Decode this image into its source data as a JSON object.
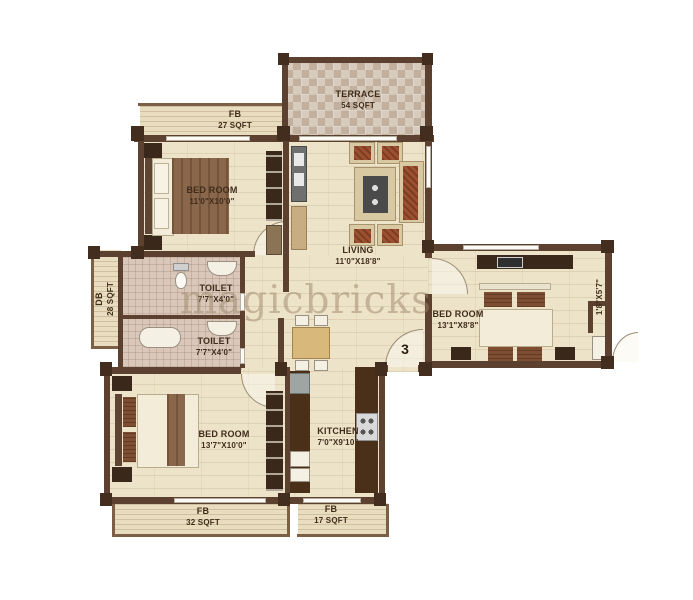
{
  "watermark": "magicbricks",
  "unit_number": "3",
  "rooms": {
    "fb_top": {
      "name": "FB",
      "area": "27 SQFT"
    },
    "terrace": {
      "name": "TERRACE",
      "area": "54 SQFT"
    },
    "bedroom_top": {
      "name": "BED ROOM",
      "dim": "11'0\"X10'0\""
    },
    "living": {
      "name": "LIVING",
      "dim": "11'0\"X18'8\""
    },
    "toilet_upper": {
      "name": "TOILET",
      "dim": "7'7\"X4'0\""
    },
    "toilet_lower": {
      "name": "TOILET",
      "dim": "7'7\"X4'0\""
    },
    "db": {
      "name": "DB",
      "area": "28 SQFT"
    },
    "bedroom_right": {
      "name": "BED ROOM",
      "dim": "13'1\"X8'8\""
    },
    "niche": {
      "dim": "1'8\"X5'7\""
    },
    "bedroom_bottom": {
      "name": "BED ROOM",
      "dim": "13'7\"X10'0\""
    },
    "kitchen": {
      "name": "KITCHEN",
      "dim": "7'0\"X9'10\""
    },
    "fb_bottom_left": {
      "name": "FB",
      "area": "32 SQFT"
    },
    "fb_bottom_right": {
      "name": "FB",
      "area": "17 SQFT"
    }
  },
  "colors": {
    "wall": "#5d4130",
    "floor": "#ede3c9",
    "terrace_tile": "#c9baa9",
    "toilet_floor": "#dac7b9",
    "cushion_accent": "#9c5030"
  }
}
